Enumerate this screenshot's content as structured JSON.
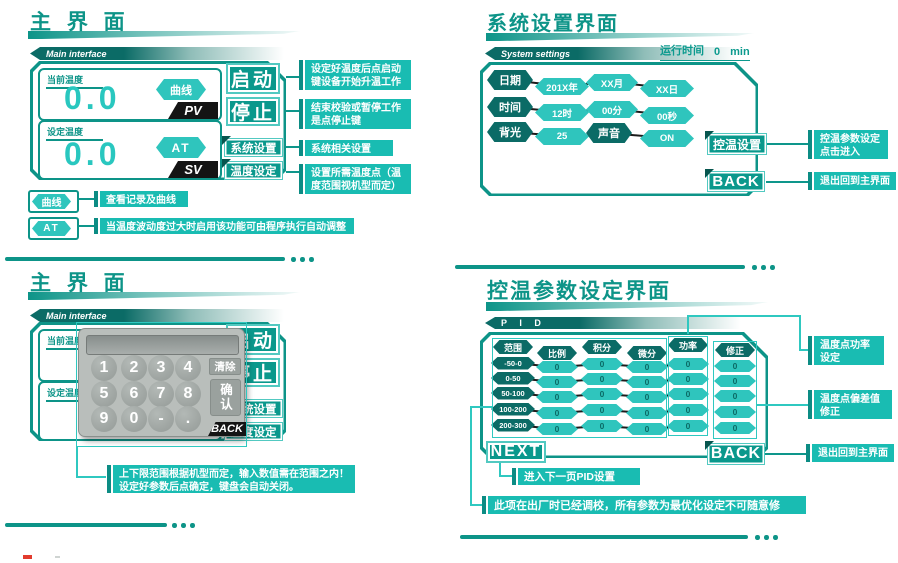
{
  "colors": {
    "teal": "#0d9488",
    "dark": "#0b6b66",
    "light": "#2fc5bd",
    "annot": "#19bcb2",
    "accent": "#0c8c84",
    "value": "#29c7bf",
    "black": "#141414"
  },
  "s1": {
    "title": "主 界 面",
    "tab": "Main interface",
    "pv_label": "当前温度",
    "pv_value": "0.0",
    "pv_badge": "PV",
    "curve_hex": "曲线",
    "sv_label": "设定温度",
    "sv_value": "0.0",
    "sv_badge": "SV",
    "at_hex": "AT",
    "btn_start": "启动",
    "btn_stop": "停止",
    "btn_system": "系统设置",
    "btn_temp": "温度设定",
    "ann_start": "设定好温度后点启动\n键设备开始升温工作",
    "ann_stop": "结束校验或暂停工作\n是点停止键",
    "ann_system": "系统相关设置",
    "ann_temp": "设置所需温度点（温\n度范围视机型而定）",
    "legend_curve": "曲线",
    "legend_curve_text": "查看记录及曲线",
    "legend_at": "AT",
    "legend_at_text": "当温度波动度过大时启用该功能可由程序执行自动调整"
  },
  "s2": {
    "title": "系统设置界面",
    "tab": "System settings",
    "runtime_label": "运行时间",
    "runtime_value": "0",
    "runtime_unit": "min",
    "date_label": "日期",
    "date_year": "201X年",
    "date_month": "XX月",
    "date_day": "XX日",
    "time_label": "时间",
    "time_hour": "12时",
    "time_min": "00分",
    "time_sec": "00秒",
    "backlight_label": "背光",
    "backlight_value": "25",
    "sound_label": "声音",
    "sound_value": "ON",
    "btn_ctrl": "控温设置",
    "btn_back": "BACK",
    "ann_ctrl": "控温参数设定\n点击进入",
    "ann_back": "退出回到主界面"
  },
  "s3": {
    "title": "主 界 面",
    "tab": "Main interface",
    "pv_label": "当前温度",
    "sv_label": "设定温度",
    "btn_start": "启动",
    "btn_stop": "停止",
    "btn_system": "系统设置",
    "btn_temp": "温度设定",
    "keypad": {
      "keys": [
        "1",
        "2",
        "3",
        "4",
        "5",
        "6",
        "7",
        "8",
        "9",
        "0",
        "-",
        "."
      ],
      "clear": "清除",
      "confirm": "确认",
      "back": "BACK"
    },
    "annotation": "上下限范围根据机型而定，输入数值需在范围之内！\n设定好参数后点确定，键盘会自动关闭。"
  },
  "s4": {
    "title": "控温参数设定界面",
    "tab": "P I D",
    "btn_next": "NEXT",
    "btn_back": "BACK",
    "ann_power": "温度点功率\n设定",
    "ann_offset": "温度点偏差值\n修正",
    "ann_back": "退出回到主界面",
    "ann_next": "进入下一页PID设置",
    "ann_factory": "此项在出厂时已经调校，所有参数为最优化设定不可随意修改！"
  },
  "chart_data": {
    "type": "table",
    "title": "PID 控温参数表",
    "columns": [
      "范围",
      "比例",
      "积分",
      "微分",
      "功率",
      "修正"
    ],
    "rows": [
      [
        "-50-0",
        "0",
        "0",
        "0",
        "0",
        "0"
      ],
      [
        "0-50",
        "0",
        "0",
        "0",
        "0",
        "0"
      ],
      [
        "50-100",
        "0",
        "0",
        "0",
        "0",
        "0"
      ],
      [
        "100-200",
        "0",
        "0",
        "0",
        "0",
        "0"
      ],
      [
        "200-300",
        "0",
        "0",
        "0",
        "0",
        "0"
      ]
    ]
  }
}
